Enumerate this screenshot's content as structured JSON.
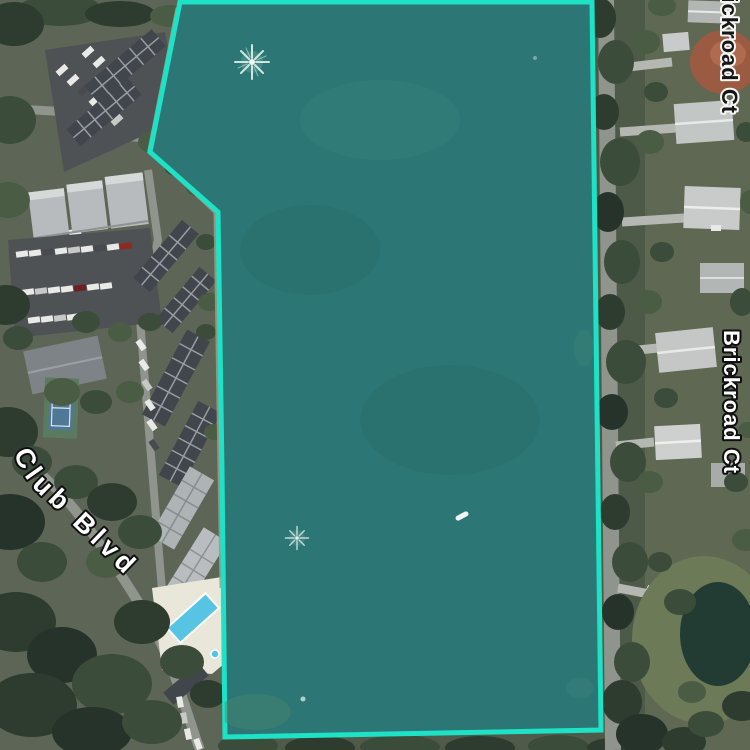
{
  "map": {
    "view": "satellite-aerial",
    "description": "Aerial view of a lake parcel highlighted in teal, bordered by a condo complex on the west and Brickroad Ct residential street on the east"
  },
  "parcel": {
    "points": "180,2 592,2 601,730 225,737 222,470 218,212 150,152",
    "fill_color": "#2c7775",
    "border_color": "#1de2c5",
    "border_width": "5"
  },
  "labels": {
    "top_right_road": {
      "text": "Brickroad Ct",
      "style": "dark-text-white-halo",
      "orientation": "vertical",
      "truncated": true
    },
    "mid_right_road": {
      "text": "Brickroad Ct",
      "style": "white-text-black-halo",
      "orientation": "vertical"
    },
    "left_road": {
      "text": "Club Blvd",
      "style": "white-text-black-halo",
      "orientation": "curved-diagonal",
      "truncated": true
    }
  },
  "features": {
    "fountain_top": {
      "transform": "translate(252,62) scale(1)"
    },
    "fountain_bottom": {
      "transform": "translate(297,538) scale(0.72)"
    },
    "boat": {
      "transform": "translate(462,516) rotate(-28)"
    },
    "pool_color": "#58c4e4",
    "tennis_court_color": "#4f7796",
    "pond_color": "#223c33"
  }
}
